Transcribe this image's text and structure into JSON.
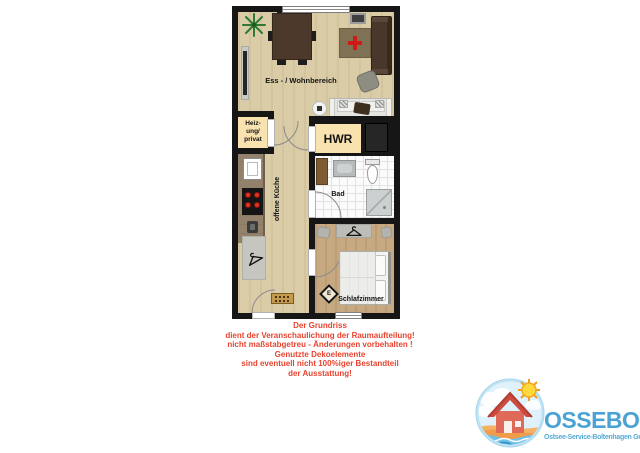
{
  "floorplan": {
    "labels": {
      "living": "Ess - / Wohnbereich",
      "heating_line1": "Heiz-",
      "heating_line2": "ung/",
      "heating_line3": "privat",
      "utility": "HWR",
      "kitchen": "offene Küche",
      "bath": "Bad",
      "bedroom": "Schlafzimmer",
      "electrical_symbol": "E"
    },
    "colors": {
      "wall": "#161616",
      "wood_floor": "#dacca7",
      "bedroom_floor": "#c7a981",
      "room_beige": "#f7e2b0",
      "decor_red": "#cf1b15"
    }
  },
  "disclaimer": {
    "color": "#e8432f",
    "lines": [
      "Der Grundriss",
      "dient der Veranschaulichung der Raumaufteilung!",
      "nicht maßstabgetreu - Änderungen vorbehalten !",
      "Genutzte Dekoelemente",
      "sind eventuell nicht 100%iger Bestandteil",
      "der Ausstattung!"
    ]
  },
  "logo": {
    "name": "OSSEBO",
    "subtitle": "Ostsee-Service-Boltenhagen GmbH",
    "text_color": "#4ba3d3"
  }
}
